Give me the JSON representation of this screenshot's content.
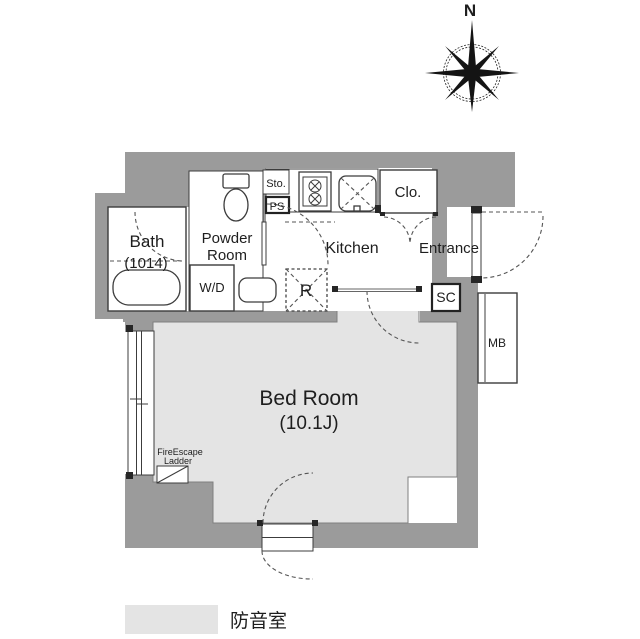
{
  "compass": {
    "north_label": "N"
  },
  "labels": {
    "bath": "Bath",
    "bath_size": "(1014)",
    "powder_line1": "Powder",
    "powder_line2": "Room",
    "wd": "W/D",
    "sto": "Sto.",
    "ps": "PS",
    "kitchen": "Kitchen",
    "clo": "Clo.",
    "entrance": "Entrance",
    "refrigerator": "R",
    "sc": "SC",
    "mb": "MB",
    "bedroom": "Bed Room",
    "bedroom_size": "(10.1J)",
    "fire_escape_line1": "FireEscape",
    "fire_escape_line2": "Ladder"
  },
  "legend": {
    "label": "防音室",
    "swatch_color": "#e4e4e4"
  },
  "colors": {
    "wall": "#9b9b9b",
    "soundproof_fill": "#e4e4e4",
    "room": "#ffffff",
    "line": "#333333"
  }
}
